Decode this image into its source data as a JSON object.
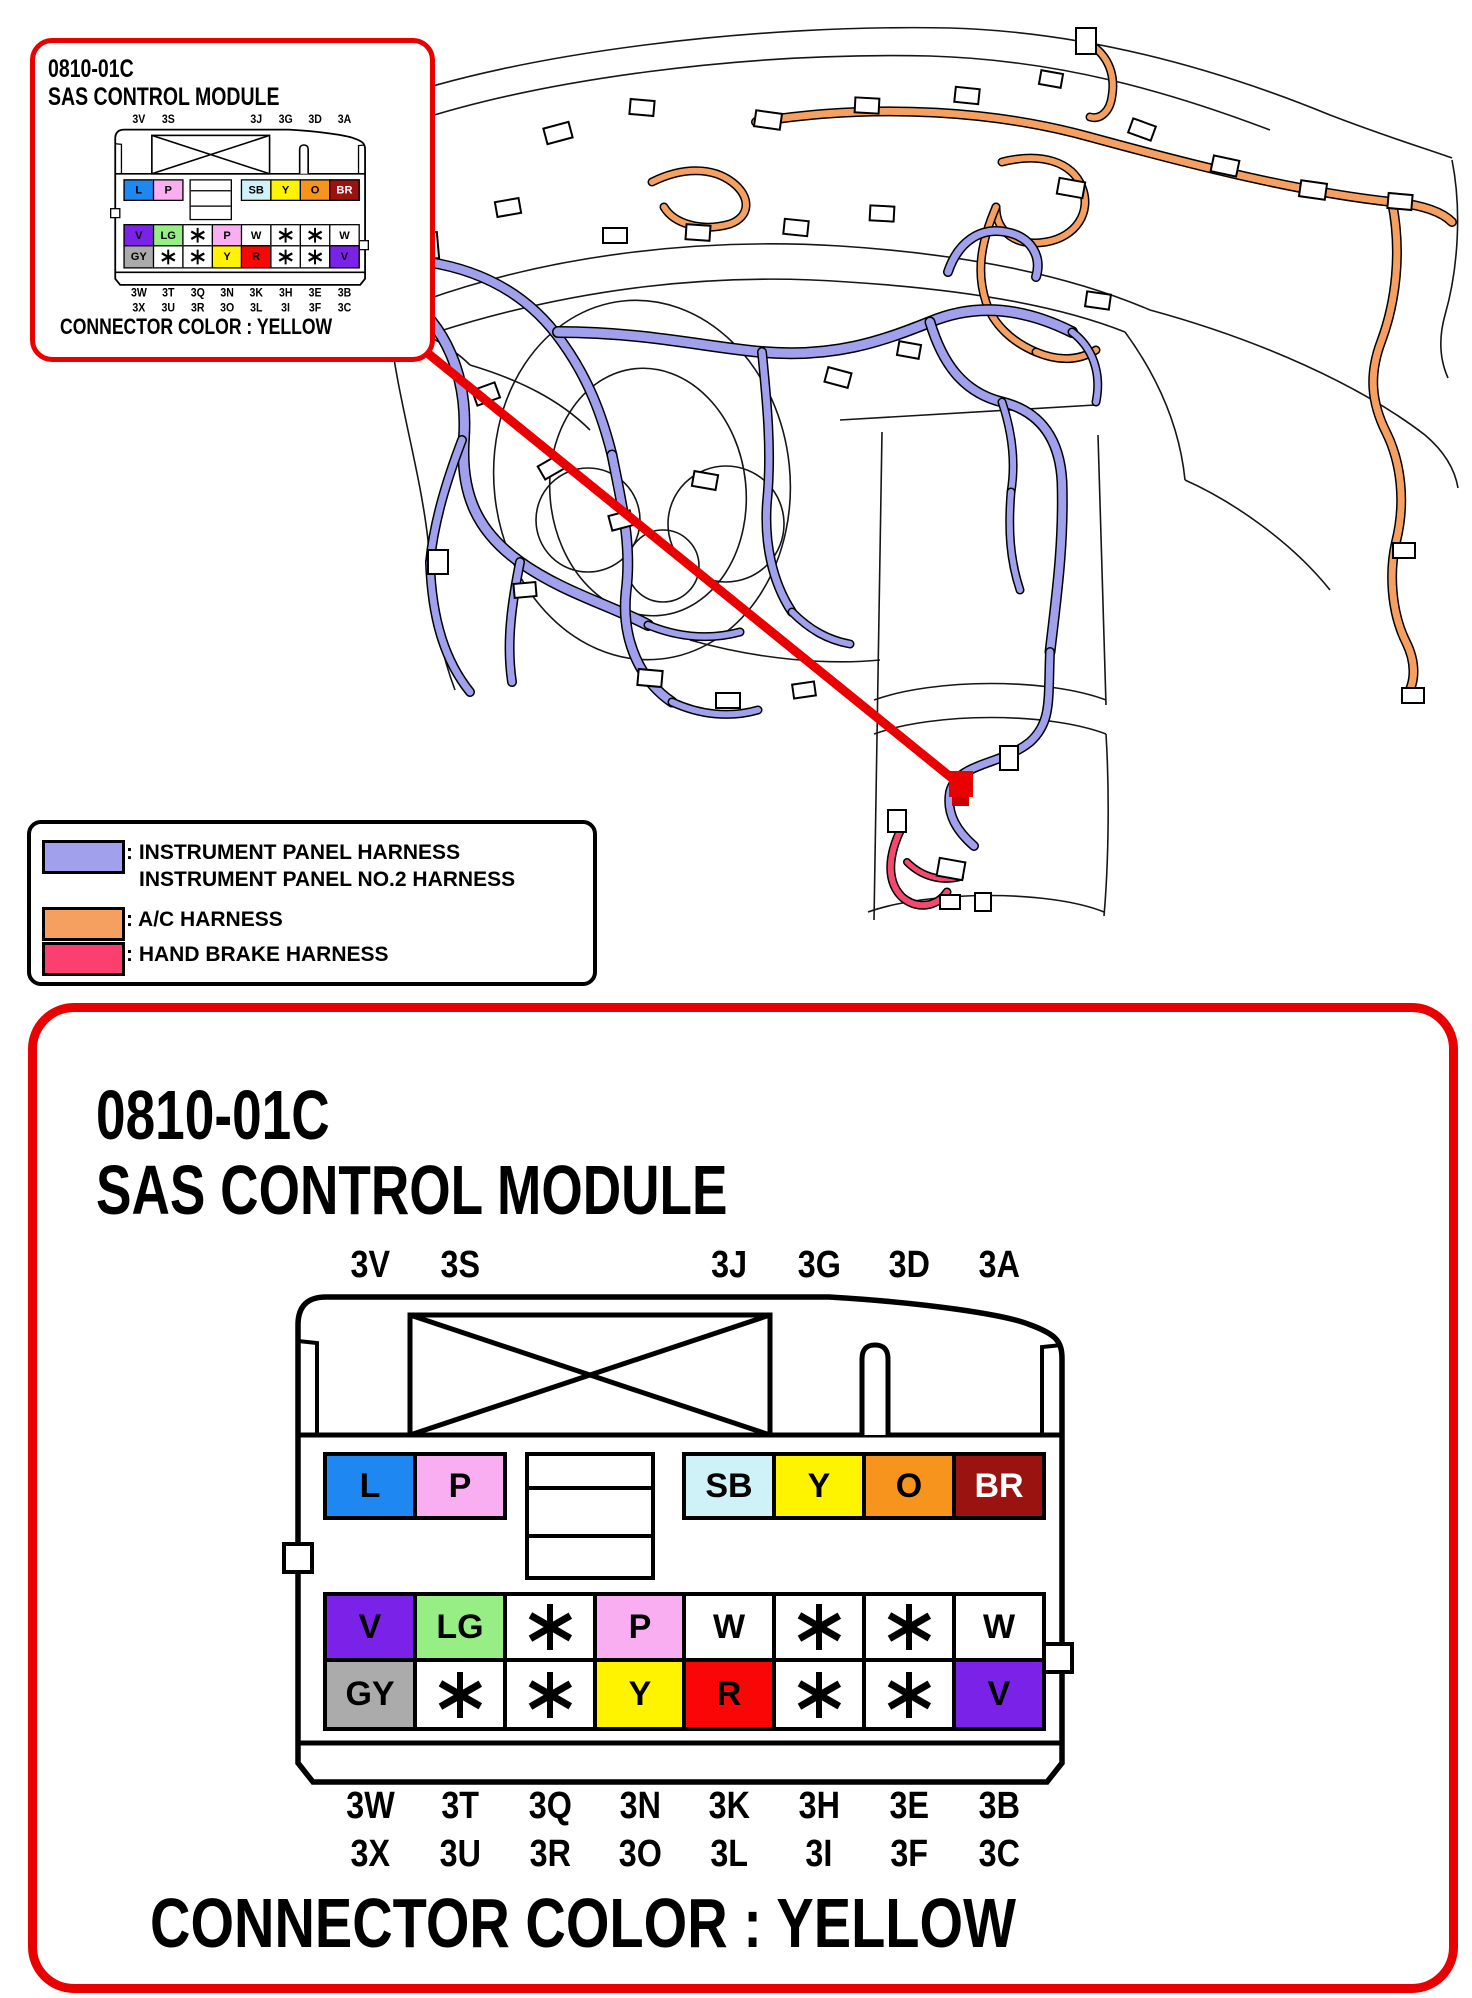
{
  "colors": {
    "accent_red": "#E90000",
    "harness_purple": "#A0A0EC",
    "harness_orange": "#F5A061",
    "harness_pink": "#F5486F"
  },
  "callout_box": {
    "code": "0810-01C",
    "title": "SAS CONTROL MODULE",
    "footer": "CONNECTOR COLOR : YELLOW"
  },
  "detail_box": {
    "code": "0810-01C",
    "title": "SAS CONTROL MODULE",
    "footer": "CONNECTOR COLOR : YELLOW"
  },
  "legend": {
    "items": [
      {
        "swatch_color": "#A0A0EC",
        "label_lines": [
          ": INSTRUMENT PANEL HARNESS",
          "INSTRUMENT PANEL NO.2 HARNESS"
        ]
      },
      {
        "swatch_color": "#F5A061",
        "label_lines": [
          ": A/C HARNESS"
        ]
      },
      {
        "swatch_color": "#FB4070",
        "label_lines": [
          ": HAND BRAKE HARNESS"
        ]
      }
    ]
  },
  "connector": {
    "connector_color": "YELLOW",
    "top_pin_labels": [
      {
        "text": "3V",
        "col": 0
      },
      {
        "text": "3S",
        "col": 1
      },
      {
        "text": "3J",
        "col": 4
      },
      {
        "text": "3G",
        "col": 5
      },
      {
        "text": "3D",
        "col": 6
      },
      {
        "text": "3A",
        "col": 7
      }
    ],
    "bottom_pin_labels_row1": [
      "3W",
      "3T",
      "3Q",
      "3N",
      "3K",
      "3H",
      "3E",
      "3B"
    ],
    "bottom_pin_labels_row2": [
      "3X",
      "3U",
      "3R",
      "3O",
      "3L",
      "3I",
      "3F",
      "3C"
    ],
    "row1_left_cells": [
      {
        "code": "L",
        "bg": "#1E87F0",
        "fg": "#000000"
      },
      {
        "code": "P",
        "bg": "#FAAEF2",
        "fg": "#000000"
      }
    ],
    "row1_right_cells": [
      {
        "code": "SB",
        "bg": "#CFF2F9",
        "fg": "#000000"
      },
      {
        "code": "Y",
        "bg": "#FEF400",
        "fg": "#000000"
      },
      {
        "code": "O",
        "bg": "#F7941E",
        "fg": "#000000"
      },
      {
        "code": "BR",
        "bg": "#9A1310",
        "fg": "#FFFFFF"
      }
    ],
    "row2_cells": [
      {
        "code": "V",
        "bg": "#7B22E8",
        "fg": "#000000"
      },
      {
        "code": "LG",
        "bg": "#97EE85",
        "fg": "#000000"
      },
      {
        "code": "*",
        "bg": "#FFFFFF",
        "fg": "#000000"
      },
      {
        "code": "P",
        "bg": "#FAAEF2",
        "fg": "#000000"
      },
      {
        "code": "W",
        "bg": "#FFFFFF",
        "fg": "#000000"
      },
      {
        "code": "*",
        "bg": "#FFFFFF",
        "fg": "#000000"
      },
      {
        "code": "*",
        "bg": "#FFFFFF",
        "fg": "#000000"
      },
      {
        "code": "W",
        "bg": "#FFFFFF",
        "fg": "#000000"
      }
    ],
    "row3_cells": [
      {
        "code": "GY",
        "bg": "#ABABAB",
        "fg": "#000000"
      },
      {
        "code": "*",
        "bg": "#FFFFFF",
        "fg": "#000000"
      },
      {
        "code": "*",
        "bg": "#FFFFFF",
        "fg": "#000000"
      },
      {
        "code": "Y",
        "bg": "#FEF400",
        "fg": "#000000"
      },
      {
        "code": "R",
        "bg": "#FA0606",
        "fg": "#000000"
      },
      {
        "code": "*",
        "bg": "#FFFFFF",
        "fg": "#000000"
      },
      {
        "code": "*",
        "bg": "#FFFFFF",
        "fg": "#000000"
      },
      {
        "code": "V",
        "bg": "#7B22E8",
        "fg": "#000000"
      }
    ]
  }
}
